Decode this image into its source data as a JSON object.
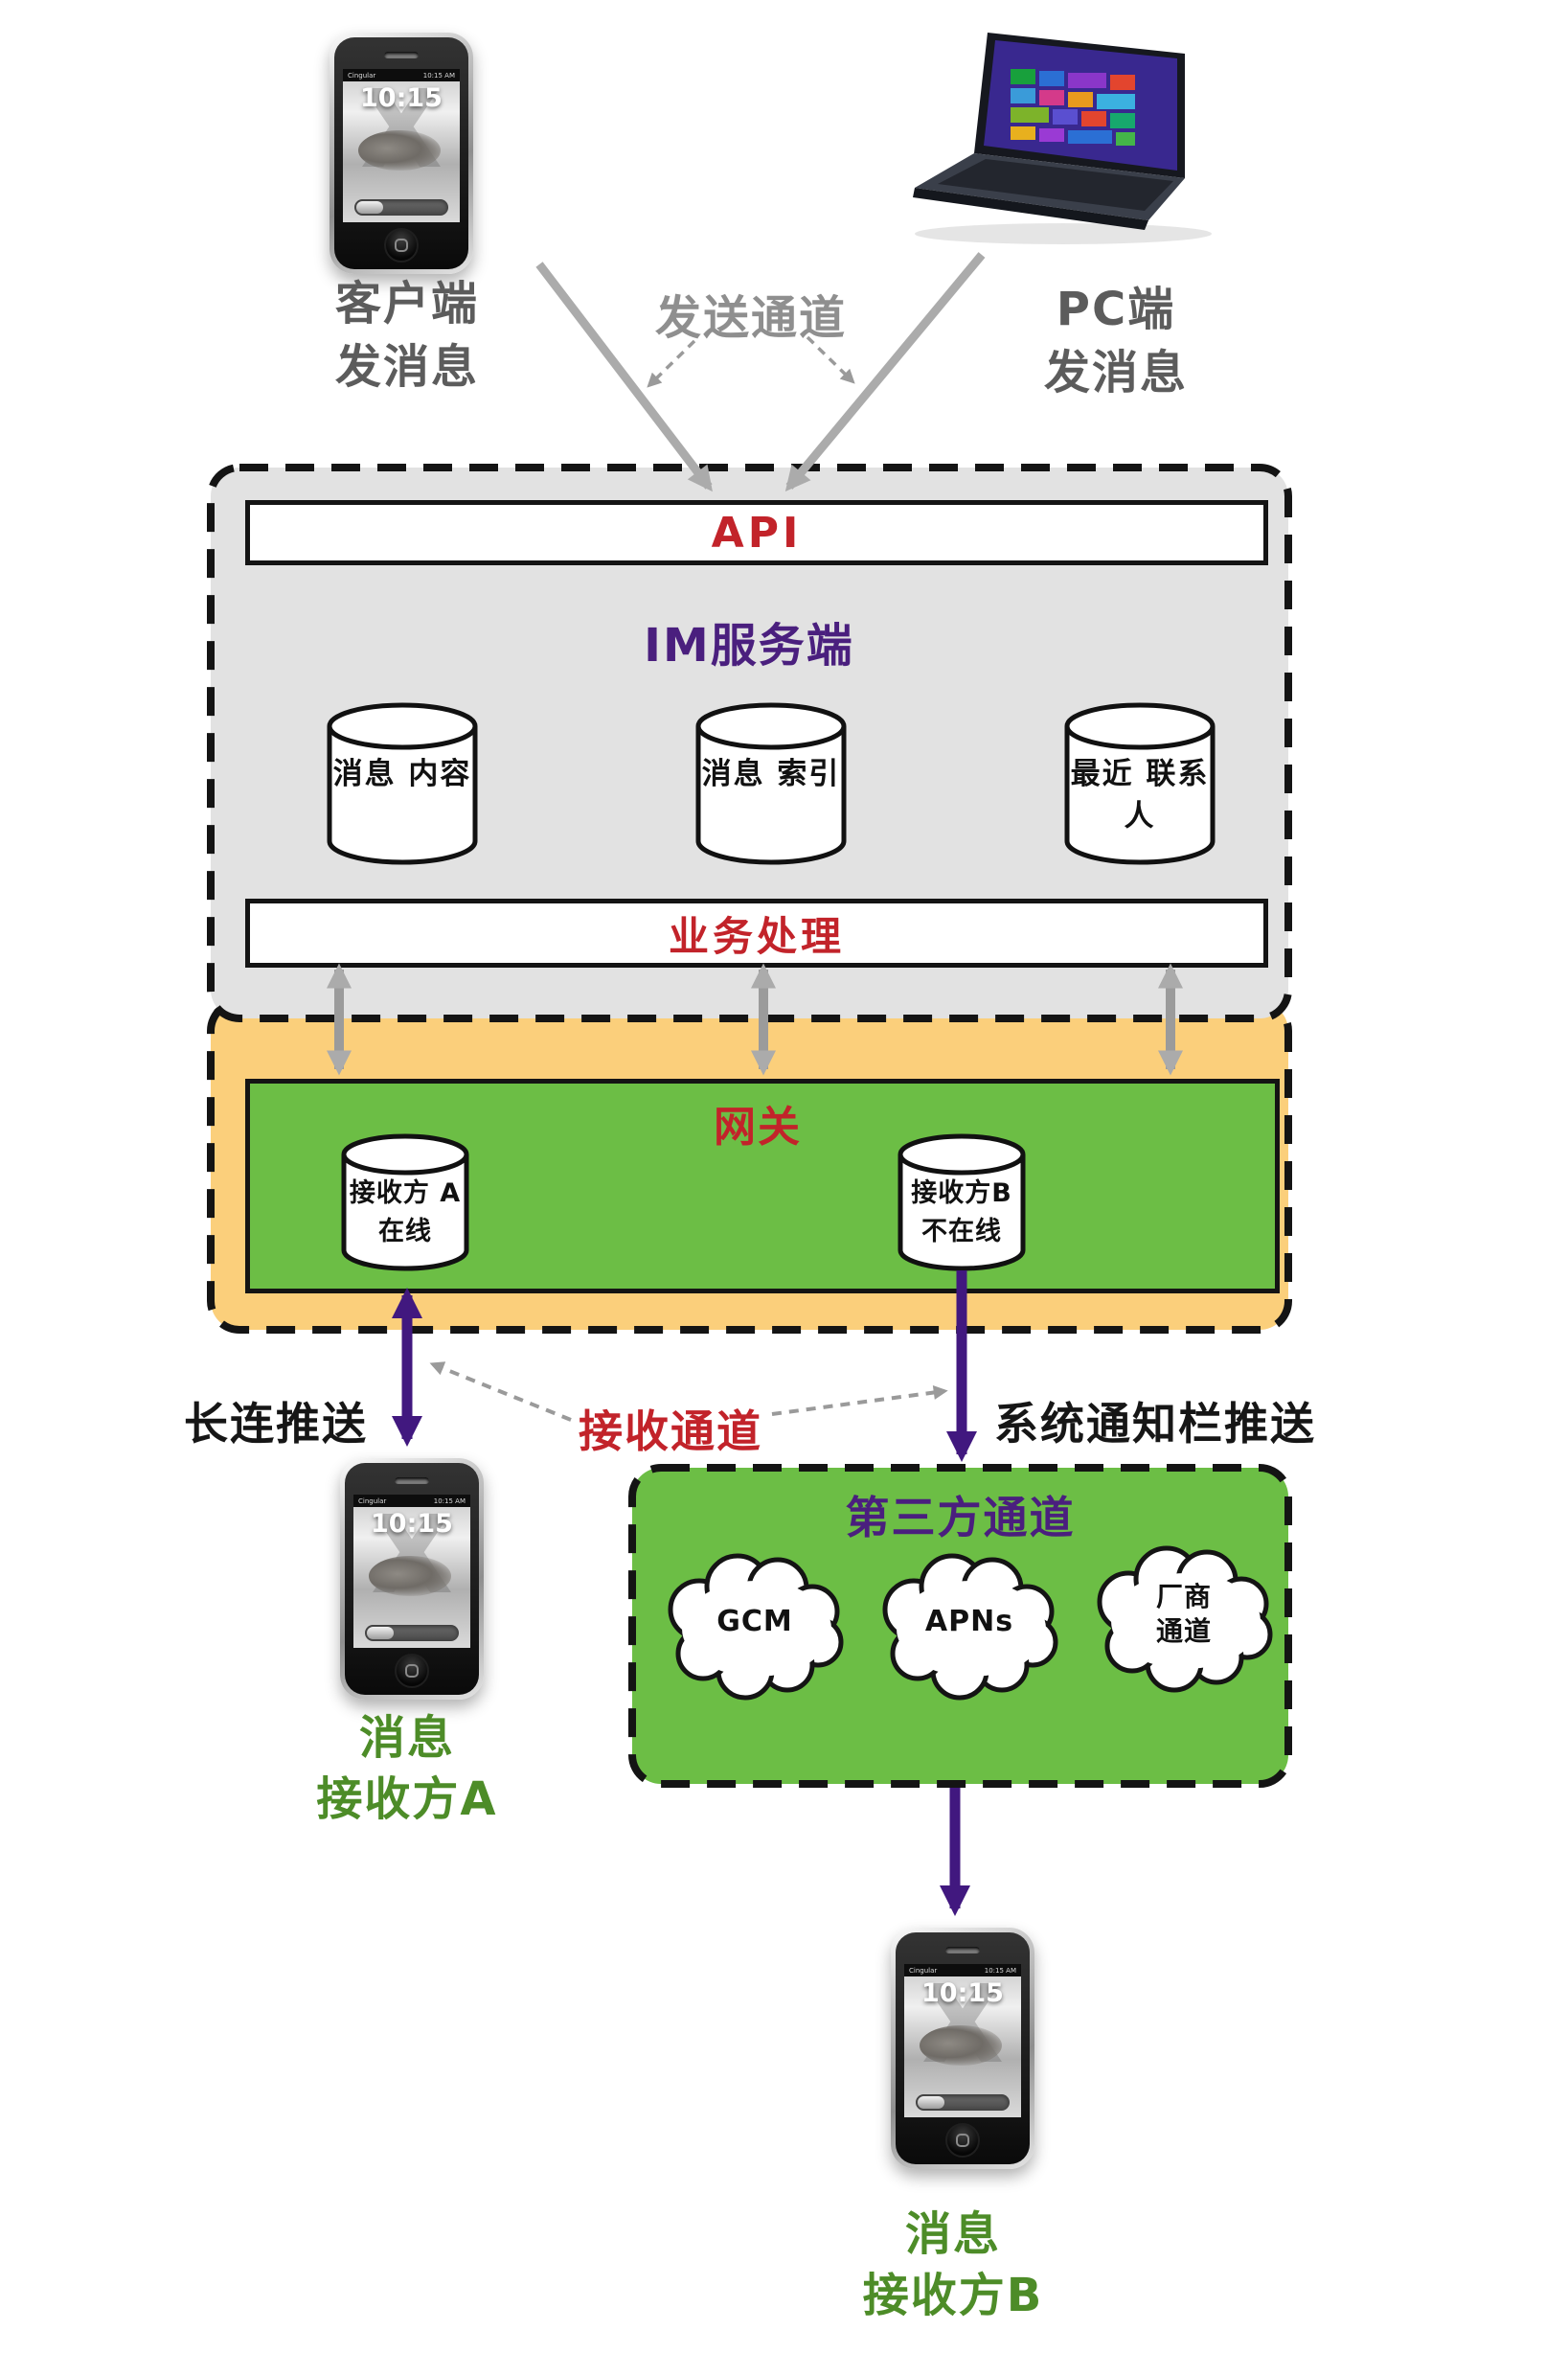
{
  "senders": {
    "client": {
      "line1": "客户端",
      "line2": "发消息"
    },
    "send_channel": "发送通道",
    "pc": {
      "line1": "PC端",
      "line2": "发消息"
    }
  },
  "im_server": {
    "api": "API",
    "title": "IM服务端",
    "stores": [
      {
        "line1": "消息",
        "line2": "内容"
      },
      {
        "line1": "消息",
        "line2": "索引"
      },
      {
        "line1": "最近",
        "line2": "联系人"
      }
    ],
    "business": "业务处理"
  },
  "gateway": {
    "title": "网关",
    "receiver_a": {
      "line1": "接收方",
      "line2": "A在线"
    },
    "receiver_b": {
      "line1": "接收方B",
      "line2": "不在线"
    }
  },
  "push_labels": {
    "long_connection_push": "长连推送",
    "receive_channel": "接收通道",
    "system_notification_push": "系统通知栏推送"
  },
  "third_party": {
    "title": "第三方通道",
    "gcm": "GCM",
    "apns": "APNs",
    "vendor": {
      "line1": "厂商",
      "line2": "通道"
    }
  },
  "receivers": {
    "a": {
      "line1": "消息",
      "line2": "接收方A"
    },
    "b": {
      "line1": "消息",
      "line2": "接收方B"
    }
  },
  "phone_screen": {
    "carrier": "Cingular",
    "status_time": "10:15 AM",
    "lock_time": "10:15",
    "watermark": "X"
  },
  "colors": {
    "accent_red": "#c2232a",
    "accent_purple": "#41187f",
    "title_purple": "#4a1f7e",
    "box_gray": "#e2e2e2",
    "box_orange": "#fbcf7b",
    "box_green": "#6cbe45",
    "label_green": "#4d8c28",
    "arrow_gray": "#ababab"
  }
}
